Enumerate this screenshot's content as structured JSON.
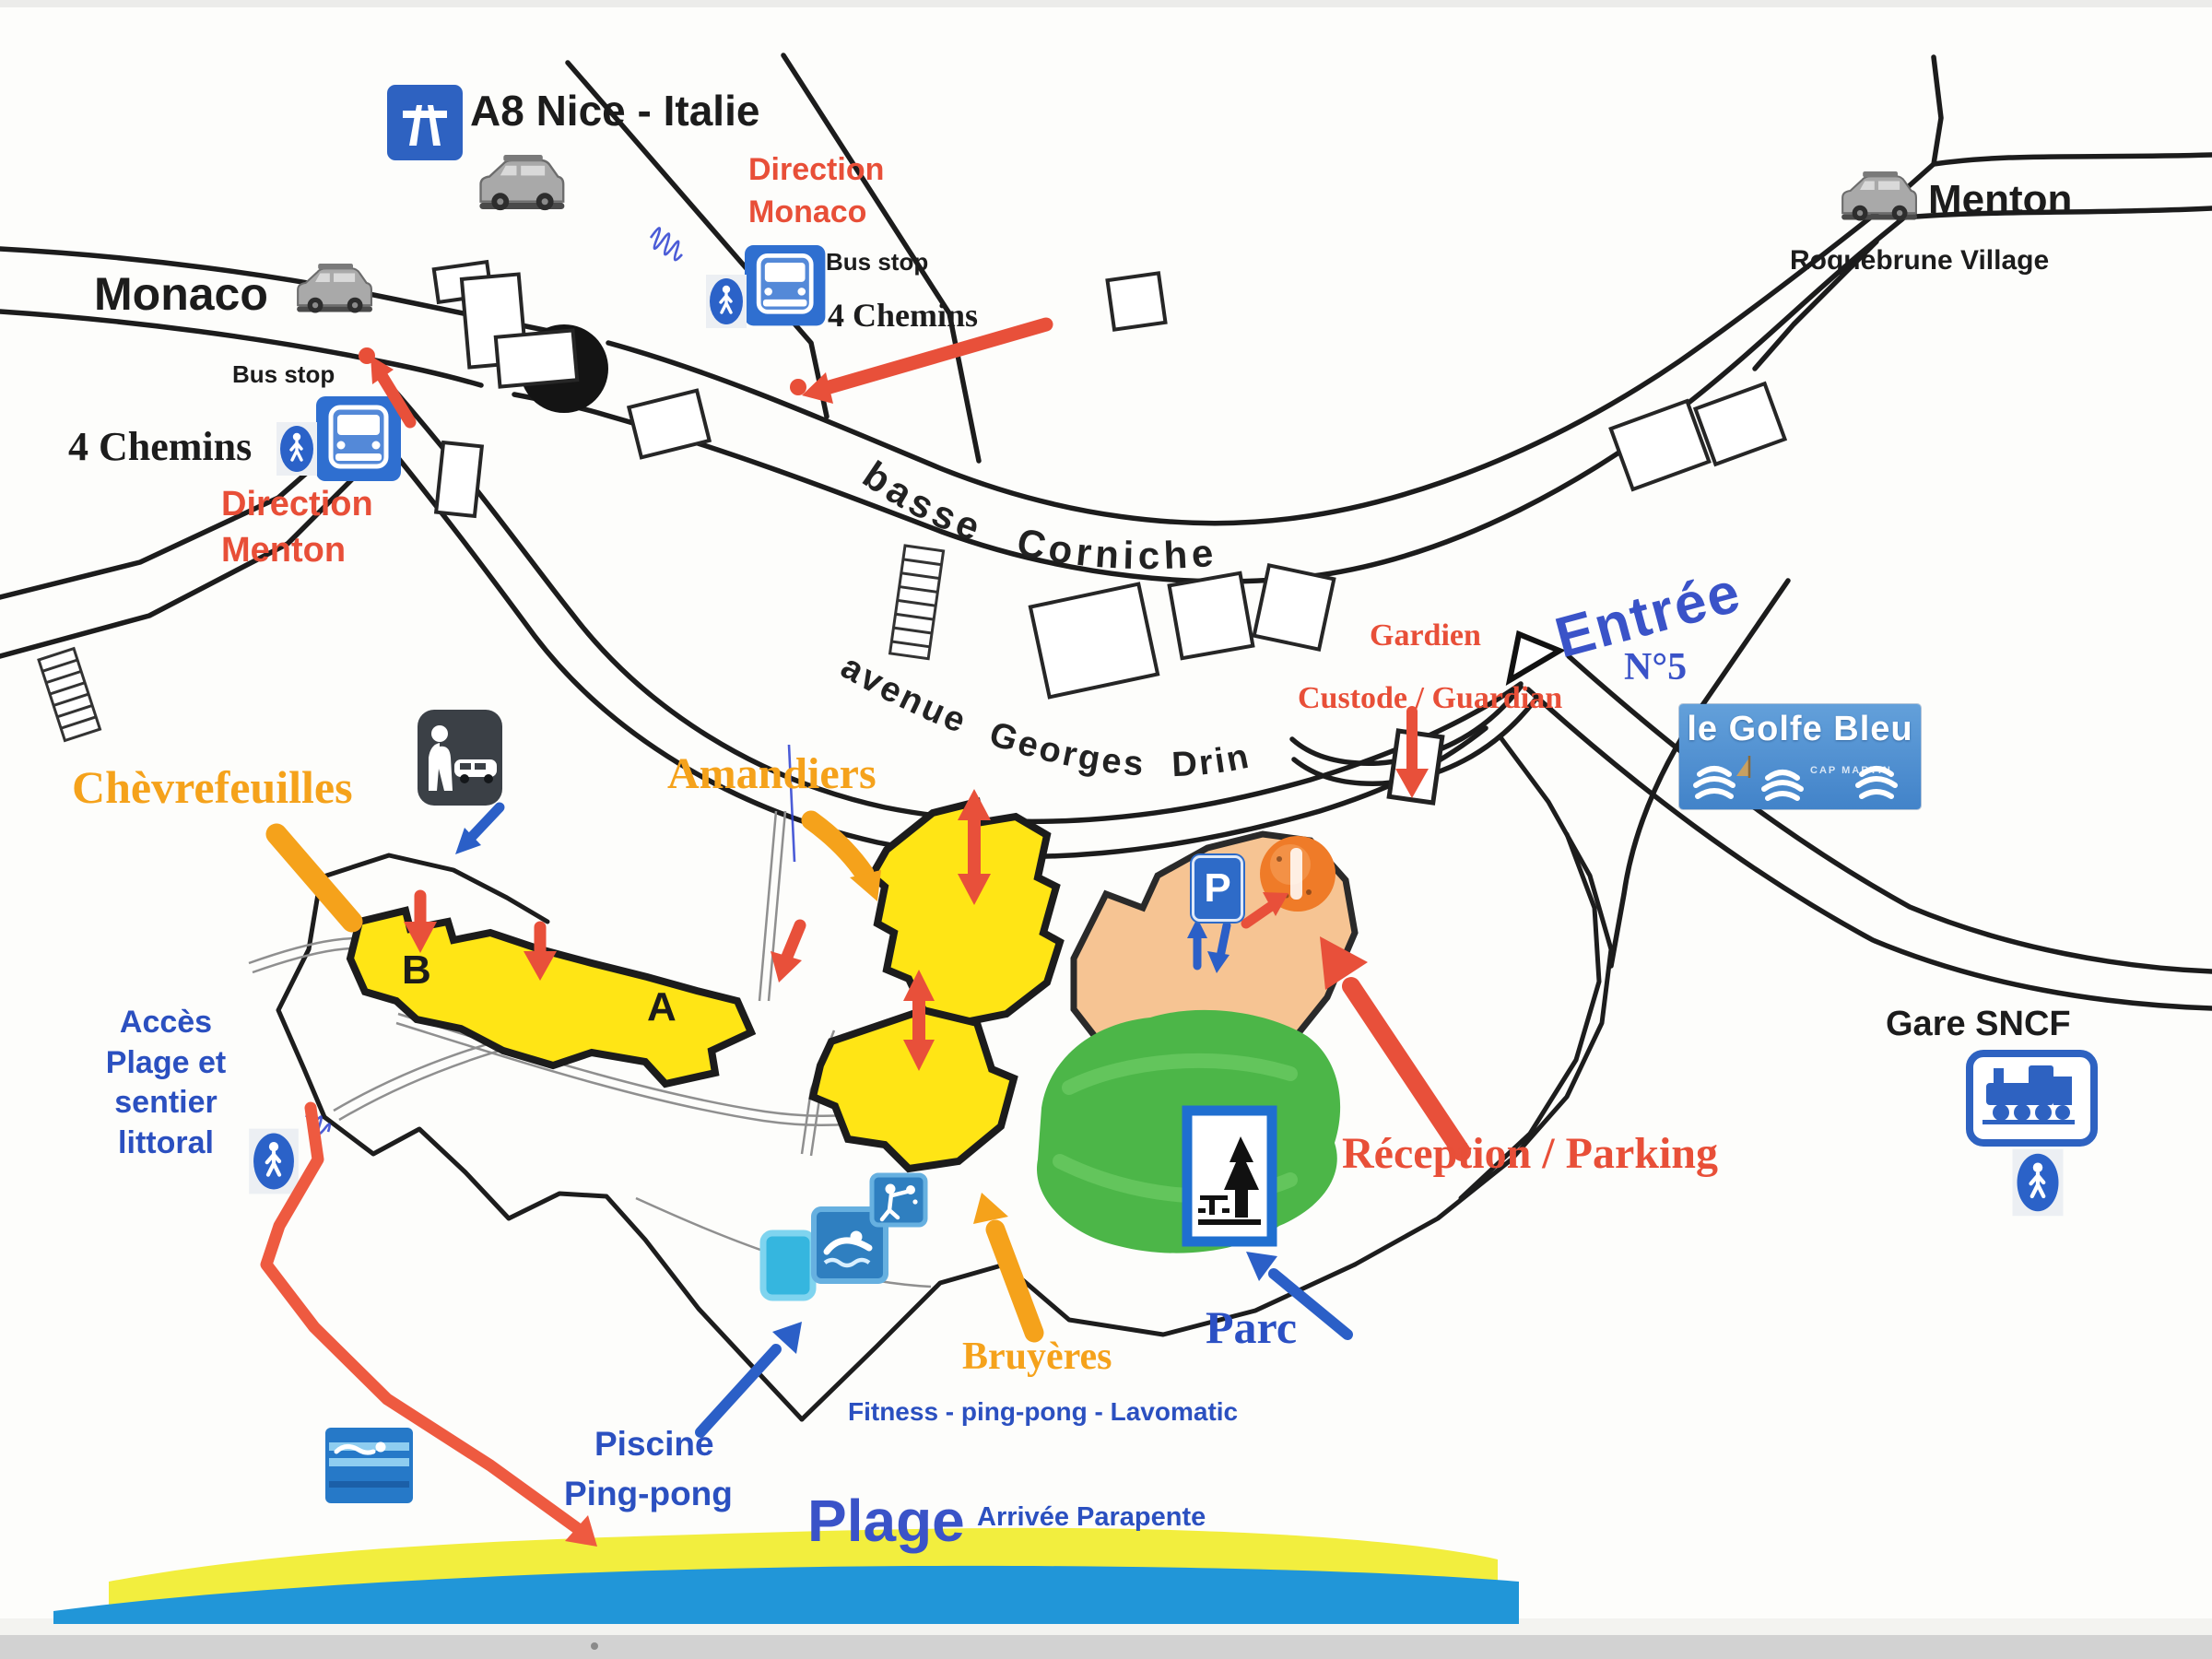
{
  "map_title": "Plan d'accès le Golfe Bleu",
  "labels": {
    "a8": "A8 Nice - Italie",
    "monaco": "Monaco",
    "bus_stop_left": "Bus stop",
    "chemins_left": "4 Chemins",
    "direction_menton": [
      "Direction",
      "Menton"
    ],
    "direction_monaco": [
      "Direction",
      "Monaco"
    ],
    "bus_stop_center": "Bus stop",
    "chemins_center": "4 Chemins",
    "menton": "Menton",
    "roquebrune": "Roquebrune Village",
    "basse_corniche": "basse Corniche",
    "avenue": "avenue Georges Drin",
    "gardien": "Gardien",
    "custode": "Custode / Guardian",
    "entree": "Entrée",
    "n5": "N°5",
    "logo_title": "le Golfe Bleu",
    "logo_sub": "CAP MARTIN",
    "chevrefeuilles": "Chèvrefeuilles",
    "amandiers": "Amandiers",
    "b": "B",
    "a": "A",
    "acces": [
      "Accès",
      "Plage et",
      "sentier",
      "littoral"
    ],
    "gare": "Gare SNCF",
    "reception": "Réception / Parking",
    "parc": "Parc",
    "bruyeres": "Bruyères",
    "fitness": "Fitness  -  ping-pong  -  Lavomatic",
    "piscine": "Piscine",
    "pingpong": "Ping-pong",
    "plage": "Plage",
    "parapente": "Arrivée Parapente",
    "p_sign": "P"
  },
  "icons": {
    "motorway-icon": "blue square with white motorway pictogram",
    "car-icon": "grey van side view",
    "bus-stop-icon": "blue square with white bus front",
    "pedestrian-icon": "blue oval with white walking figure",
    "attended-parking-icon": "dark square, person beside car",
    "parking-icon": "blue P sign",
    "reception-marker-icon": "orange highlighted dot",
    "park-picnic-icon": "blue framed square, pine tree and picnic table",
    "pool-icon": "blue square with swimmer",
    "pingpong-icon": "blue square with table-tennis player",
    "sea-swim-icon": "blue square with waves and swimmer",
    "train-icon": "blue framed square with locomotive",
    "roundabout-icon": "black oval",
    "stairs-icon": "hatched steps strip"
  },
  "colors": {
    "red_accent": "#e84f38",
    "blue_accent": "#2b50c0",
    "orange_accent": "#f5a21b",
    "building_yellow": "#ffe515",
    "park_green": "#4cb648",
    "reception_salmon": "#f6c493",
    "sea_blue": "#2196d8",
    "sand_yellow": "#f2ee3e",
    "sign_blue": "#2e6bc8",
    "road_black": "#1c1c1c"
  }
}
